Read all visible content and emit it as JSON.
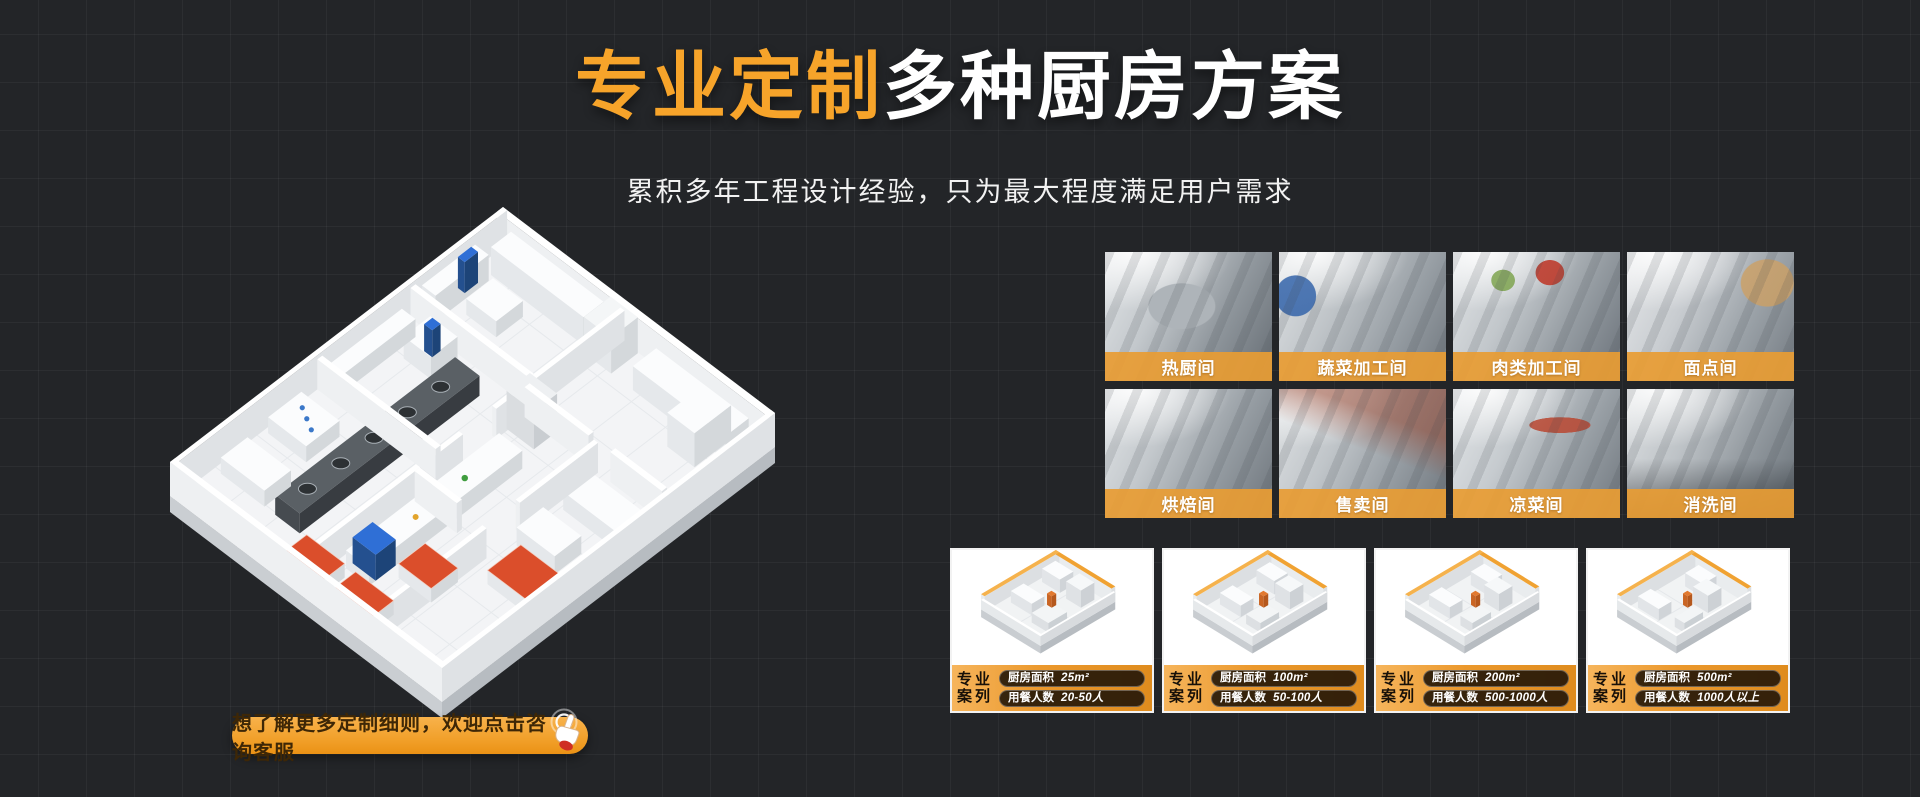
{
  "page": {
    "background": "#232528",
    "accent_orange": "#f7a42a",
    "banner_orange": "#e89c33"
  },
  "hero": {
    "title_highlight": "专业定制",
    "title_rest": "多种厨房方案",
    "subtitle": "累积多年工程设计经验，只为最大程度满足用户需求"
  },
  "rooms": [
    {
      "label": "热厨间"
    },
    {
      "label": "蔬菜加工间"
    },
    {
      "label": "肉类加工间"
    },
    {
      "label": "面点间"
    },
    {
      "label": "烘焙间"
    },
    {
      "label": "售卖间"
    },
    {
      "label": "凉菜间"
    },
    {
      "label": "消洗间"
    }
  ],
  "cases": [
    {
      "tag_line1": "专业",
      "tag_line2": "案列",
      "area_label": "厨房面积",
      "area_value": "25m²",
      "diners_label": "用餐人数",
      "diners_value": "20-50人"
    },
    {
      "tag_line1": "专业",
      "tag_line2": "案列",
      "area_label": "厨房面积",
      "area_value": "100m²",
      "diners_label": "用餐人数",
      "diners_value": "50-100人"
    },
    {
      "tag_line1": "专业",
      "tag_line2": "案列",
      "area_label": "厨房面积",
      "area_value": "200m²",
      "diners_label": "用餐人数",
      "diners_value": "500-1000人"
    },
    {
      "tag_line1": "专业",
      "tag_line2": "案列",
      "area_label": "厨房面积",
      "area_value": "500m²",
      "diners_label": "用餐人数",
      "diners_value": "1000人以上"
    }
  ],
  "cta": {
    "label": "想了解更多定制细则，欢迎点击咨询客服"
  }
}
